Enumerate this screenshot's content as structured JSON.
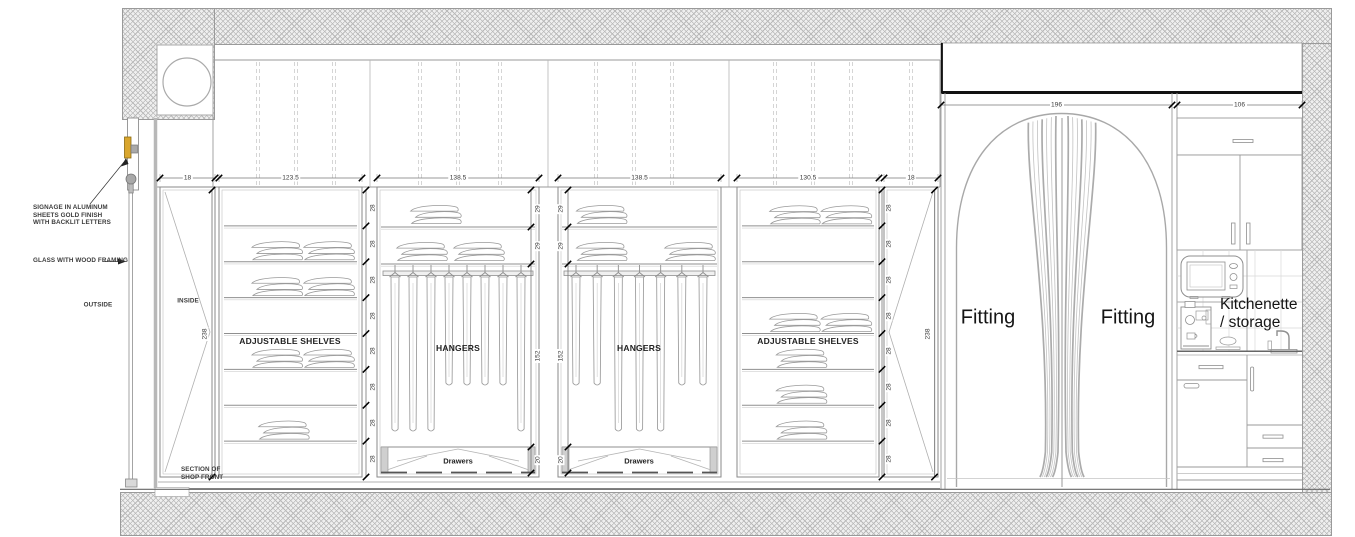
{
  "drawing_title": "Section of shop front - wardrobe, fitting rooms and kitchenette elevation",
  "annotations": {
    "signage_lines": [
      "SIGNAGE IN ALUMINUM",
      "SHEETS GOLD FINISH",
      "WITH BACKLIT LETTERS"
    ],
    "glass": "GLASS WITH WOOD FRAMING",
    "outside": "OUTSIDE",
    "inside": "INSIDE",
    "section_lines": [
      "SECTION OF",
      "SHOP FRONT"
    ]
  },
  "dimensions": {
    "top": [
      "18",
      "123.5",
      "138.5",
      "138.5",
      "130.5",
      "18"
    ],
    "wing": [
      "196",
      "106"
    ],
    "door_height": "238",
    "shelf_rows": [
      "28",
      "28",
      "28",
      "28",
      "28",
      "28",
      "28",
      "28"
    ],
    "hanger_stack": [
      "29",
      "29",
      "152",
      "20"
    ]
  },
  "bays": [
    {
      "type": "shelves",
      "label": "ADJUSTABLE SHELVES",
      "clothes_rows": {
        "2": 2,
        "3": 2,
        "5": 2,
        "7": 1
      }
    },
    {
      "type": "hangers",
      "label": "HANGERS",
      "drawers_label": "Drawers",
      "top_rows": [
        1,
        2
      ],
      "hanger_lengths": [
        "long",
        "long",
        "long",
        "short",
        "short",
        "short",
        "short",
        "long"
      ]
    },
    {
      "type": "hangers",
      "label": "HANGERS",
      "drawers_label": "Drawers",
      "top_rows": [
        1,
        2
      ],
      "hanger_lengths": [
        "short",
        "short",
        "long",
        "long",
        "long",
        "short",
        "short"
      ]
    },
    {
      "type": "shelves",
      "label": "ADJUSTABLE SHELVES",
      "clothes_rows": {
        "1": 2,
        "4": 2,
        "5": 1,
        "6": 1,
        "7": 1
      }
    }
  ],
  "fitting": {
    "left_label": "Fitting",
    "right_label": "Fitting"
  },
  "kitchenette": {
    "label_lines": [
      "Kitchenette",
      "/ storage"
    ]
  },
  "colors": {
    "gold": "#D9A62E",
    "line": "#9a9a9a",
    "dark": "#111111",
    "text": "#333333"
  }
}
